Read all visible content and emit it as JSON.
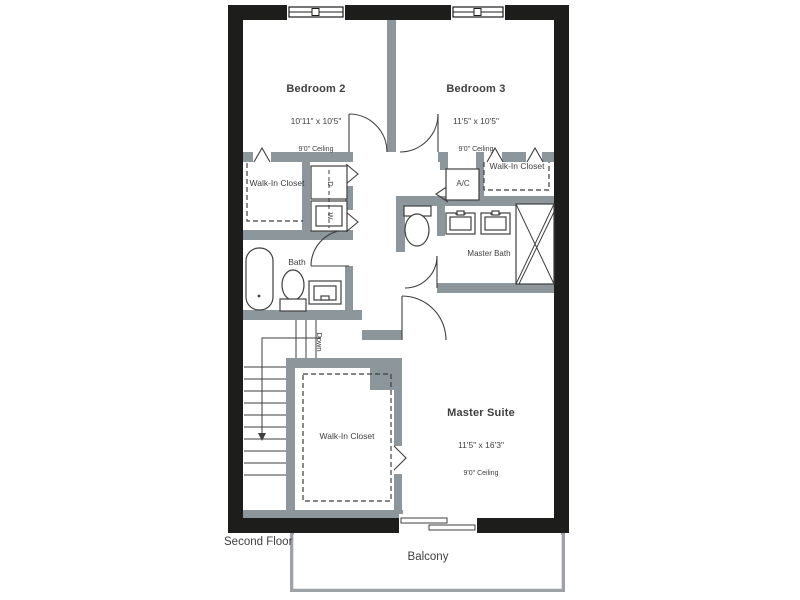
{
  "floor_plan": {
    "floor_label": "Second Floor",
    "balcony_label": "Balcony",
    "rooms": {
      "bedroom2": {
        "name": "Bedroom 2",
        "dims": "10'11\" x 10'5\"",
        "ceiling": "9'0\" Ceiling"
      },
      "bedroom3": {
        "name": "Bedroom 3",
        "dims": "11'5\" x 10'5\"",
        "ceiling": "9'0\" Ceiling"
      },
      "master_suite": {
        "name": "Master Suite",
        "dims": "11'5\" x 16'3\"",
        "ceiling": "9'0\" Ceiling"
      },
      "walk_in_closet_left": "Walk-In Closet",
      "walk_in_closet_right": "Walk-In Closet",
      "walk_in_closet_master": "Walk-In Closet",
      "bath": "Bath",
      "master_bath": "Master Bath",
      "ac": "A/C",
      "stairs_direction": "Down",
      "dryer": "D",
      "washer": "W"
    },
    "colors": {
      "outer_wall": "#1d1d1b",
      "interior_wall": "#8d969b",
      "line": "#3f3f3f",
      "balcony_wall": "#9ba3a8"
    }
  }
}
